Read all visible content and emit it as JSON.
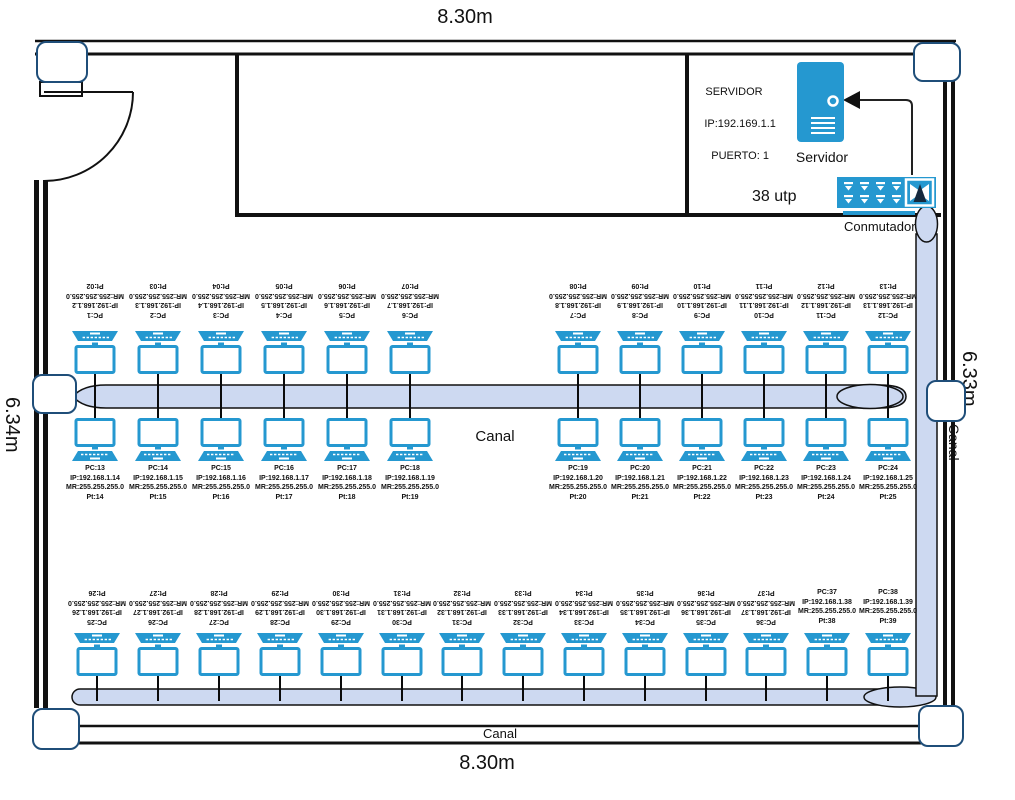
{
  "dimensions": {
    "top": "8.30m",
    "bottom": "8.30m",
    "left": "6.34m",
    "right": "6.33m"
  },
  "canal_labels": {
    "middle": "Canal",
    "bottom": "Canal",
    "right": "Canal"
  },
  "server": {
    "info_lines": [
      "SERVIDOR",
      "IP:192.169.1.1",
      "PUERTO: 1"
    ],
    "caption": "Servidor"
  },
  "switch": {
    "utp_label": "38 utp",
    "caption": "Conmutador"
  },
  "colors": {
    "device_blue": "#2598d0",
    "canal_fill": "#cdd9f1",
    "corner_border": "#1f4e79",
    "wall": "#111111"
  },
  "icons": {
    "server": "server-tower-icon",
    "switch": "network-switch-icon",
    "pc": "workstation-icon",
    "door": "door-swing-arc",
    "arrow": "arrow-to-server"
  },
  "pcs": {
    "row1": [
      {
        "pc": "PC:1",
        "ip": "IP:192.168.1.2",
        "mr": "MR:255.255.255.0",
        "pt": "Pt:02"
      },
      {
        "pc": "PC:2",
        "ip": "IP:192.168.1.3",
        "mr": "MR:255.255.255.0",
        "pt": "Pt:03"
      },
      {
        "pc": "PC:3",
        "ip": "IP:192.168.1.4",
        "mr": "MR:255.255.255.0",
        "pt": "Pt:04"
      },
      {
        "pc": "PC:4",
        "ip": "IP:192.168.1.5",
        "mr": "MR:255.255.255.0",
        "pt": "Pt:05"
      },
      {
        "pc": "PC:5",
        "ip": "IP:192.168.1.6",
        "mr": "MR:255.255.255.0",
        "pt": "Pt:06"
      },
      {
        "pc": "PC:6",
        "ip": "IP:192.168.1.7",
        "mr": "MR:255.255.255.0",
        "pt": "Pt:07"
      },
      {
        "pc": "PC:7",
        "ip": "IP:192.168.1.8",
        "mr": "MR:255.255.255.0",
        "pt": "Pt:08"
      },
      {
        "pc": "PC:8",
        "ip": "IP:192.168.1.9",
        "mr": "MR:255.255.255.0",
        "pt": "Pt:09"
      },
      {
        "pc": "PC:9",
        "ip": "IP:192.168.1.10",
        "mr": "MR:255.255.255.0",
        "pt": "Pt:10"
      },
      {
        "pc": "PC:10",
        "ip": "IP:192.168.1.11",
        "mr": "MR:255.255.255.0",
        "pt": "Pt:11"
      },
      {
        "pc": "PC:11",
        "ip": "IP:192.168.1.12",
        "mr": "MR:255.255.255.0",
        "pt": "Pt:12"
      },
      {
        "pc": "PC:12",
        "ip": "IP:192.168.1.13",
        "mr": "MR:255.255.255.0",
        "pt": "Pt:13"
      }
    ],
    "row2": [
      {
        "pc": "PC:13",
        "ip": "IP:192.168.1.14",
        "mr": "MR:255.255.255.0",
        "pt": "Pt:14"
      },
      {
        "pc": "PC:14",
        "ip": "IP:192.168.1.15",
        "mr": "MR:255.255.255.0",
        "pt": "Pt:15"
      },
      {
        "pc": "PC:15",
        "ip": "IP:192.168.1.16",
        "mr": "MR:255.255.255.0",
        "pt": "Pt:16"
      },
      {
        "pc": "PC:16",
        "ip": "IP:192.168.1.17",
        "mr": "MR:255.255.255.0",
        "pt": "Pt:17"
      },
      {
        "pc": "PC:17",
        "ip": "IP:192.168.1.18",
        "mr": "MR:255.255.255.0",
        "pt": "Pt:18"
      },
      {
        "pc": "PC:18",
        "ip": "IP:192.168.1.19",
        "mr": "MR:255.255.255.0",
        "pt": "Pt:19"
      },
      {
        "pc": "PC:19",
        "ip": "IP:192.168.1.20",
        "mr": "MR:255.255.255.0",
        "pt": "Pt:20"
      },
      {
        "pc": "PC:20",
        "ip": "IP:192.168.1.21",
        "mr": "MR:255.255.255.0",
        "pt": "Pt:21"
      },
      {
        "pc": "PC:21",
        "ip": "IP:192.168.1.22",
        "mr": "MR:255.255.255.0",
        "pt": "Pt:22"
      },
      {
        "pc": "PC:22",
        "ip": "IP:192.168.1.23",
        "mr": "MR:255.255.255.0",
        "pt": "Pt:23"
      },
      {
        "pc": "PC:23",
        "ip": "IP:192.168.1.24",
        "mr": "MR:255.255.255.0",
        "pt": "Pt:24"
      },
      {
        "pc": "PC:24",
        "ip": "IP:192.168.1.25",
        "mr": "MR:255.255.255.0",
        "pt": "Pt:25"
      }
    ],
    "row3": [
      {
        "pc": "PC:25",
        "ip": "IP:192.168.1.26",
        "mr": "MR:255.255.255.0",
        "pt": "Pt:26"
      },
      {
        "pc": "PC:26",
        "ip": "IP:192.168.1.27",
        "mr": "MR:255.255.255.0",
        "pt": "Pt:27"
      },
      {
        "pc": "PC:27",
        "ip": "IP:192.168.1.28",
        "mr": "MR:255.255.255.0",
        "pt": "Pt:28"
      },
      {
        "pc": "PC:28",
        "ip": "IP:192.168.1.29",
        "mr": "MR:255.255.255.0",
        "pt": "Pt:29"
      },
      {
        "pc": "PC:29",
        "ip": "IP:192.168.1.30",
        "mr": "MR:255.255.255.0",
        "pt": "Pt:30"
      },
      {
        "pc": "PC:30",
        "ip": "IP:192.168.1.31",
        "mr": "MR:255.255.255.0",
        "pt": "Pt:31"
      },
      {
        "pc": "PC:31",
        "ip": "IP:192.168.1.32",
        "mr": "MR:255.255.255.0",
        "pt": "Pt:32"
      },
      {
        "pc": "PC:32",
        "ip": "IP:192.168.1.33",
        "mr": "MR:255.255.255.0",
        "pt": "Pt:33"
      },
      {
        "pc": "PC:33",
        "ip": "IP:192.168.1.34",
        "mr": "MR:255.255.255.0",
        "pt": "Pt:34"
      },
      {
        "pc": "PC:34",
        "ip": "IP:192.168.1.35",
        "mr": "MR:255.255.255.0",
        "pt": "Pt:35"
      },
      {
        "pc": "PC:35",
        "ip": "IP:192.168.1.36",
        "mr": "MR:255.255.255.0",
        "pt": "Pt:36"
      },
      {
        "pc": "PC:36",
        "ip": "IP:192.168.1.37",
        "mr": "MR:255.255.255.0",
        "pt": "Pt:37"
      },
      {
        "pc": "PC:37",
        "ip": "IP:192.168.1.38",
        "mr": "MR:255.255.255.0",
        "pt": "Pt:38",
        "label_flipped": false
      },
      {
        "pc": "PC:38",
        "ip": "IP:192.168.1.39",
        "mr": "MR:255.255.255.0",
        "pt": "Pt:39",
        "label_flipped": false
      }
    ]
  }
}
